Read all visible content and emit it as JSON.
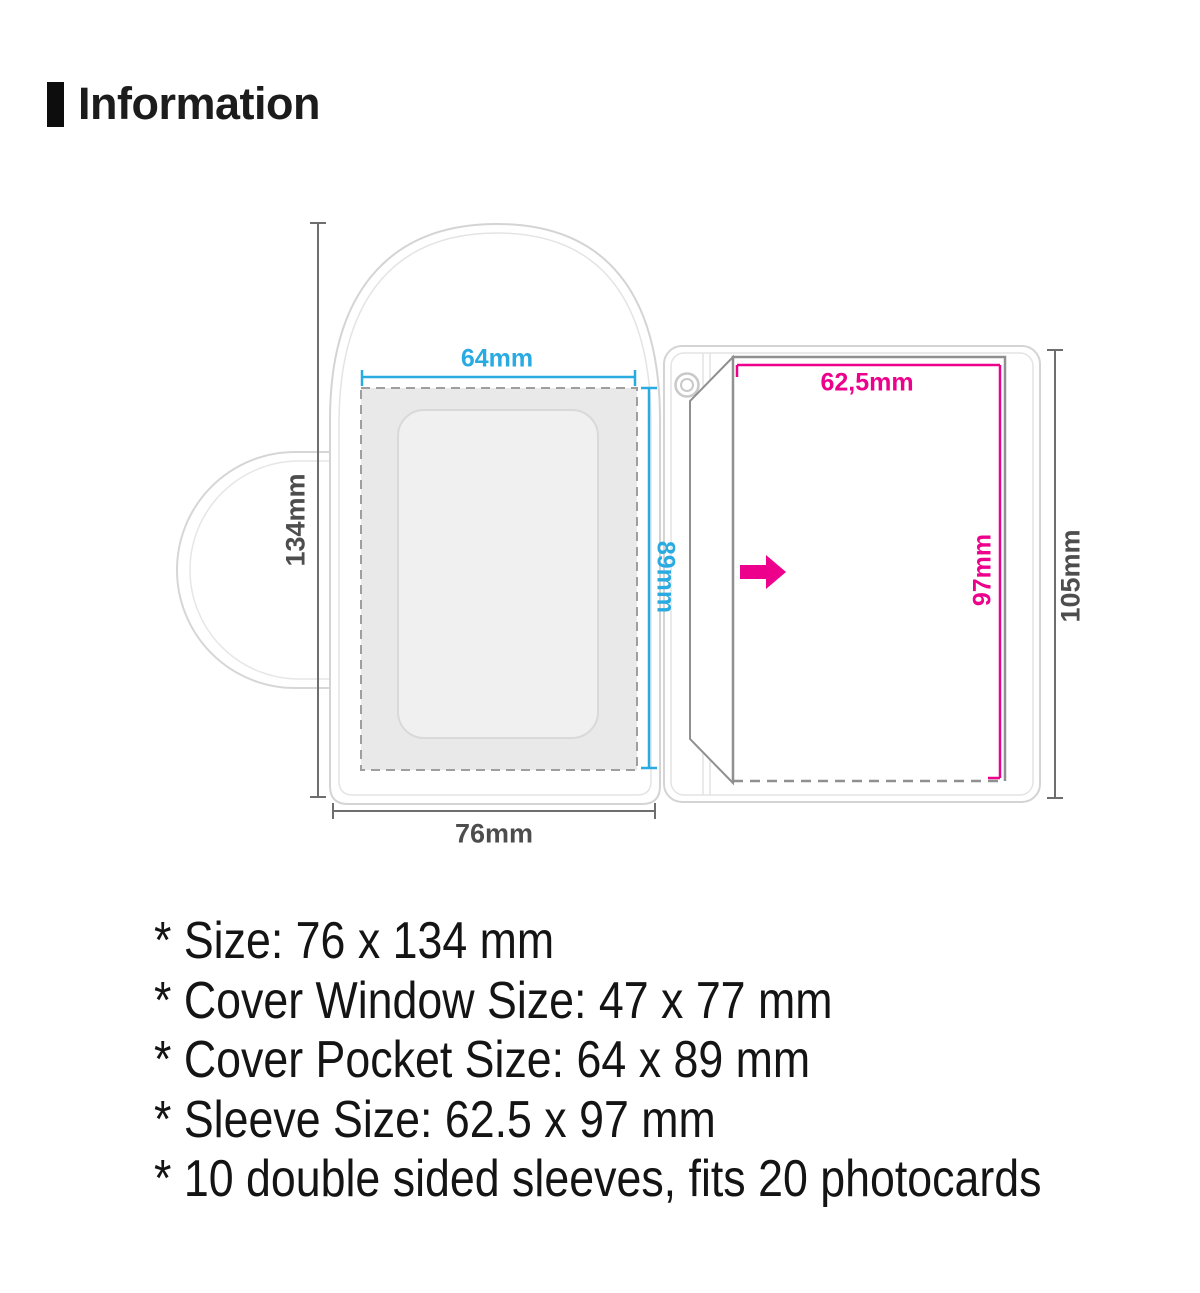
{
  "header": {
    "title": "Information"
  },
  "diagram": {
    "labels": {
      "cover_pocket_width": "64mm",
      "cover_pocket_height": "89mm",
      "cover_height": "134mm",
      "cover_width": "76mm",
      "sleeve_width": "62,5mm",
      "sleeve_height": "97mm",
      "page_height": "105mm"
    },
    "icons": {
      "ring_hole": "binder-ring-hole",
      "insert_arrow": "insert-direction-arrow"
    },
    "colors": {
      "cyan": "#29abe2",
      "magenta": "#ec008c",
      "dark_label": "#4d4d4d",
      "dim_line": "#6e6e6e",
      "outline_light": "#d4d4d4",
      "sleeve_outline": "#909090",
      "pocket_fill": "#e9e9e9"
    }
  },
  "specs": {
    "items": [
      "* Size: 76 x 134 mm",
      "* Cover Window Size: 47 x 77 mm",
      "* Cover Pocket Size: 64 x 89 mm",
      "* Sleeve Size: 62.5 x 97 mm",
      "* 10 double sided sleeves, fits 20 photocards"
    ]
  }
}
